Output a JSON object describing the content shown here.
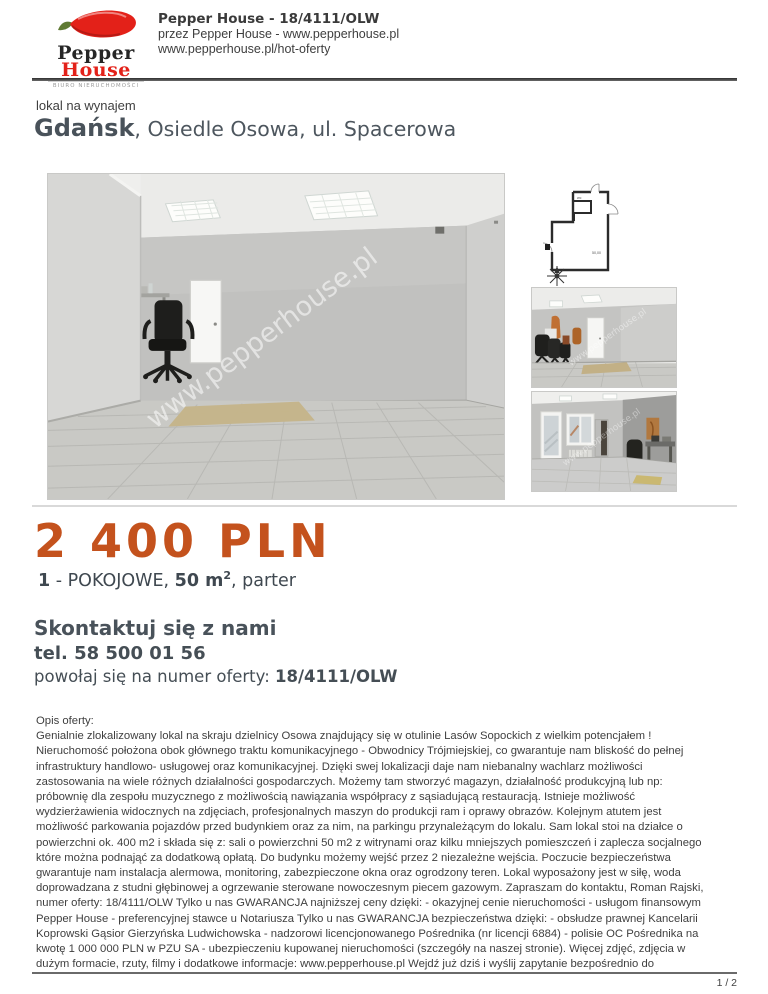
{
  "colors": {
    "accent_orange": "#c4521d",
    "logo_red": "#e32119",
    "heading_gray": "#49525a"
  },
  "header": {
    "title": "Pepper House - 18/4111/OLW",
    "byline": "przez Pepper House - www.pepperhouse.pl",
    "url": "www.pepperhouse.pl/hot-oferty",
    "logo": {
      "brand_top": "Pepper",
      "brand_bottom": "House",
      "tagline": "BIURO NIERUCHOMOŚCI"
    }
  },
  "listing": {
    "type_label": "lokal na wynajem",
    "city": "Gdańsk",
    "location_rest": ", Osiedle Osowa, ul. Spacerowa",
    "price": "2 400 PLN",
    "specs": {
      "rooms": "1",
      "rooms_suffix": " - POKOJOWE, ",
      "area": "50 m",
      "area_exp": "2",
      "tail": ", parter"
    }
  },
  "contact": {
    "heading": "Skontaktuj się z nami",
    "phone": "tel. 58 500 01 56",
    "offer_ref_label": "powołaj się na numer oferty: ",
    "offer_number": "18/4111/OLW"
  },
  "photos": {
    "watermark": "www.pepperhouse.pl"
  },
  "plan": {
    "room_label": "wc",
    "area_label": "50,00"
  },
  "description": {
    "label": "Opis oferty:",
    "lines": [
      "Genialnie zlokalizowany lokal na skraju dzielnicy Osowa znajdujący się w otulinie Lasów Sopockich z wielkim potencjałem !",
      "Nieruchomość położona obok głównego traktu komunikacyjnego - Obwodnicy Trójmiejskiej, co gwarantuje nam bliskość do pełnej",
      "infrastruktury handlowo- usługowej oraz komunikacyjnej. Dzięki swej lokalizacji daje nam niebanalny wachlarz możliwości",
      "zastosowania na wiele różnych działalności gospodarczych. Możemy tam stworzyć magazyn, działalność produkcyjną lub np:",
      "próbownię dla zespołu muzycznego z możliwością nawiązania współpracy z sąsiadującą restauracją. Istnieje możliwość",
      "wydzierżawienia widocznych na zdjęciach, profesjonalnych maszyn do produkcji ram i oprawy obrazów. Kolejnym atutem jest",
      "możliwość parkowania pojazdów przed budynkiem oraz za nim, na parkingu przynależącym do lokalu. Sam lokal stoi na działce o",
      "powierzchni ok. 400 m2 i składa się z: sali o powierzchni 50 m2 z witrynami oraz kilku mniejszych pomieszczeń i zaplecza socjalnego",
      "które można podnająć za dodatkową opłatą. Do budynku możemy wejść przez 2 niezależne wejścia. Poczucie bezpieczeństwa",
      "gwarantuje nam instalacja alermowa, monitoring, zabezpieczone okna oraz ogrodzony teren. Lokal wyposażony jest w siłę, woda",
      "doprowadzana z studni głębinowej a ogrzewanie sterowane nowoczesnym piecem gazowym. Zapraszam do kontaktu, Roman Rajski,",
      "numer oferty: 18/4111/OLW Tylko u nas GWARANCJA najniższej ceny dzięki: - okazyjnej cenie nieruchomości - usługom finansowym",
      "Pepper House - preferencyjnej stawce u Notariusza Tylko u nas GWARANCJA bezpieczeństwa dzięki: - obsłudze prawnej Kancelarii",
      "Koprowski Gąsior Gierzyńska Ludwichowska - nadzorowi licencjonowanego Pośrednika (nr licencji 6884) - polisie OC Pośrednika na",
      "kwotę 1 000 000 PLN w PZU SA - ubezpieczeniu kupowanej nieruchomości (szczegóły na naszej stronie). Więcej zdjęć, zdjęcia w",
      "dużym formacie, rzuty, filmy i dodatkowe informacje: www.pepperhouse.pl Wejdź już dziś i wyślij zapytanie bezpośrednio do"
    ]
  },
  "footer": {
    "page_number": "1 / 2"
  }
}
